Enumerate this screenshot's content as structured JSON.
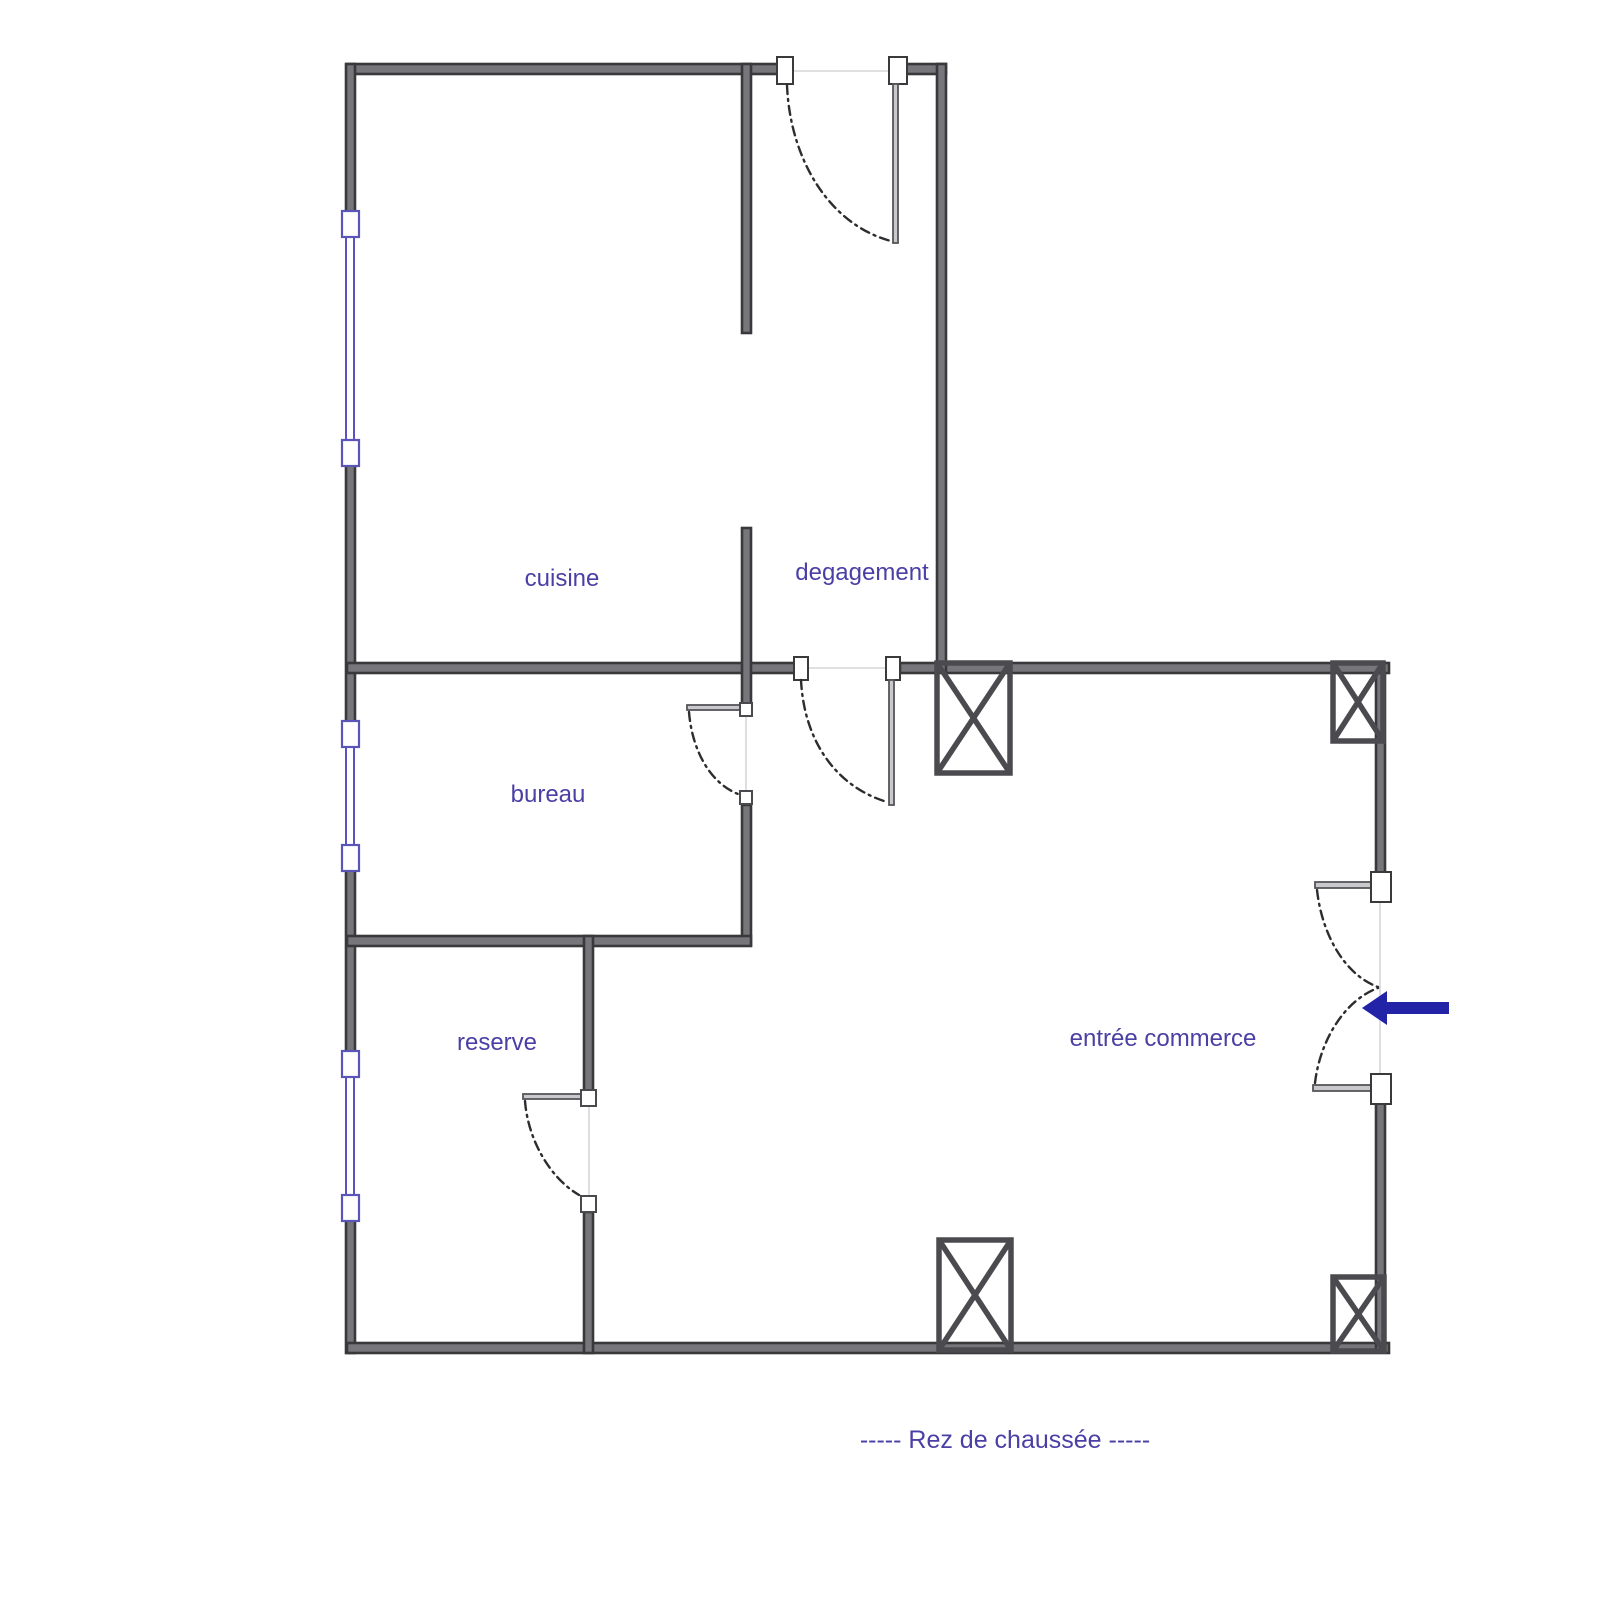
{
  "plan": {
    "caption": "-----  Rez de chaussée  -----",
    "rooms": [
      {
        "label": "cuisine"
      },
      {
        "label": "degagement"
      },
      {
        "label": "bureau"
      },
      {
        "label": "reserve"
      },
      {
        "label": "entrée commerce"
      }
    ],
    "symbols": {
      "window": "blue-double-line-window",
      "door": "dash-dot-swing-arc-door",
      "column": "crossed-box-column",
      "entrance_arrow": "blue-left-arrow"
    }
  },
  "colors": {
    "wall-dark": "#39393c",
    "wall-mid": "#77777b",
    "window-blue": "#5a52c4",
    "window-border": "#5c55b8",
    "label-blue": "#4a3fa5",
    "arrow-blue": "#2323a8",
    "arc-dark": "#2d2d30",
    "open-line": "#d6d6d8",
    "leaf-fill": "#c9c9cc",
    "leaf-stroke": "#55555a",
    "column-stroke": "#4b4b4f"
  }
}
